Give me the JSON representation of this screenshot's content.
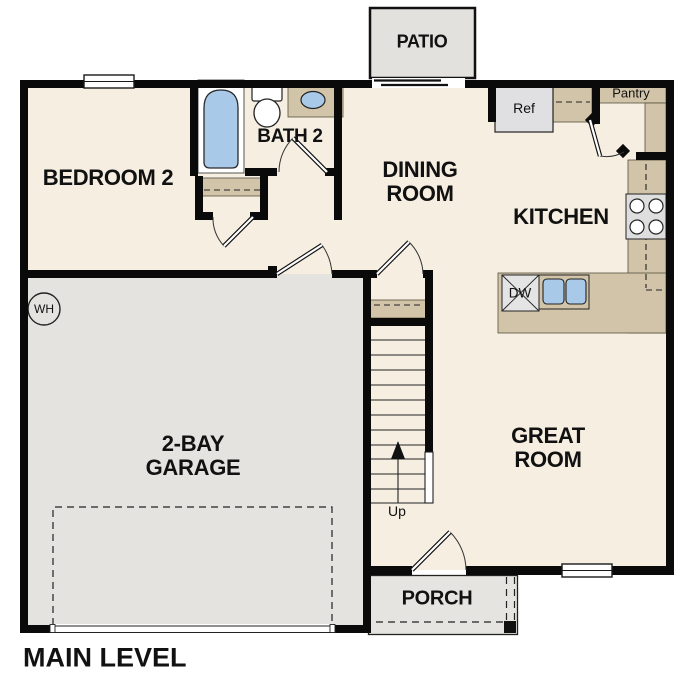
{
  "plan_title": "MAIN LEVEL",
  "palette": {
    "wall": "#0a0a0a",
    "floor-cream": "#f5eee1",
    "garage-gray": "#e4e3e0",
    "patio-gray": "#e2e1dd",
    "porch-gray": "#e5e4e1",
    "cabinet-tan": "#d2c4a9",
    "fixture-blue": "#a9c9e9",
    "appliance-gray": "#dedede",
    "text": "#111111"
  },
  "rooms": {
    "patio": "PATIO",
    "bedroom2": "BEDROOM 2",
    "bath2": "BATH 2",
    "dining_line1": "DINING",
    "dining_line2": "ROOM",
    "kitchen": "KITCHEN",
    "pantry": "Pantry",
    "great_line1": "GREAT",
    "great_line2": "ROOM",
    "garage_line1": "2-BAY",
    "garage_line2": "GARAGE",
    "porch": "PORCH"
  },
  "fixtures": {
    "refrigerator": "Ref",
    "dishwasher": "DW",
    "water_heater": "WH",
    "stairs_direction": "Up"
  }
}
